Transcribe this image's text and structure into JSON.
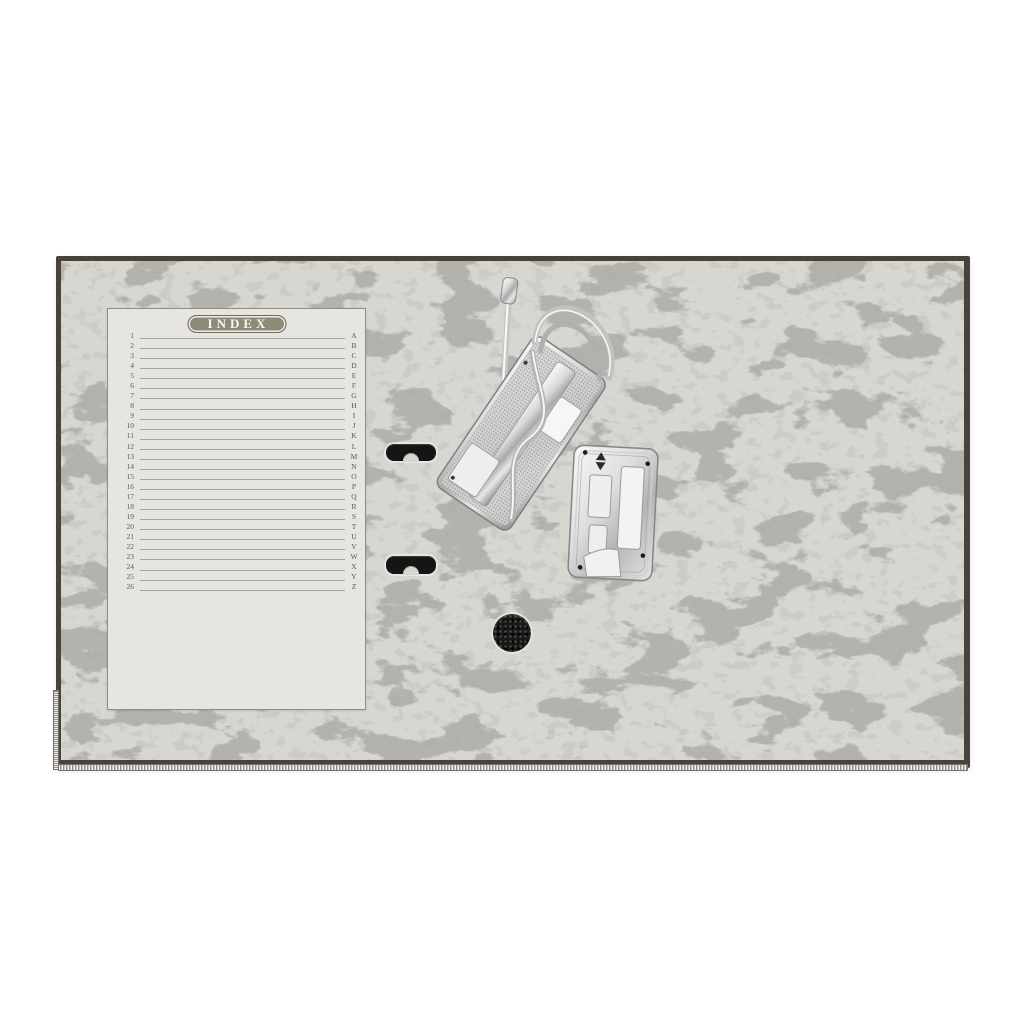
{
  "scene": {
    "subject": "lever arch file binder opened, inside view",
    "parts": [
      "marble-board",
      "index-card",
      "lever-arch-mechanism",
      "compressor-plate",
      "finger-slot-top",
      "finger-slot-bottom",
      "grip-hole",
      "metal-edge-strip-bottom",
      "metal-edge-strip-left"
    ]
  },
  "index_card": {
    "title": "INDEX",
    "rows": [
      {
        "num": "1",
        "letter": "A"
      },
      {
        "num": "2",
        "letter": "B"
      },
      {
        "num": "3",
        "letter": "C"
      },
      {
        "num": "4",
        "letter": "D"
      },
      {
        "num": "5",
        "letter": "E"
      },
      {
        "num": "6",
        "letter": "F"
      },
      {
        "num": "7",
        "letter": "G"
      },
      {
        "num": "8",
        "letter": "H"
      },
      {
        "num": "9",
        "letter": "I"
      },
      {
        "num": "10",
        "letter": "J"
      },
      {
        "num": "11",
        "letter": "K"
      },
      {
        "num": "12",
        "letter": "L"
      },
      {
        "num": "13",
        "letter": "M"
      },
      {
        "num": "14",
        "letter": "N"
      },
      {
        "num": "15",
        "letter": "O"
      },
      {
        "num": "16",
        "letter": "P"
      },
      {
        "num": "17",
        "letter": "Q"
      },
      {
        "num": "18",
        "letter": "R"
      },
      {
        "num": "19",
        "letter": "S"
      },
      {
        "num": "20",
        "letter": "T"
      },
      {
        "num": "21",
        "letter": "U"
      },
      {
        "num": "22",
        "letter": "V"
      },
      {
        "num": "23",
        "letter": "W"
      },
      {
        "num": "24",
        "letter": "X"
      },
      {
        "num": "25",
        "letter": "Y"
      },
      {
        "num": "26",
        "letter": "Z"
      }
    ]
  },
  "colors": {
    "page_bg": "#ffffff",
    "cover_edge": "#48423a",
    "texture_base": "#d8d6d1",
    "texture_fiber": "#6f6c65",
    "card_bg": "#e6e5e0",
    "card_border": "#8f8d86",
    "pill_bg": "#8f8a79",
    "pill_text": "#f7f6f2",
    "rule_line": "#9d9a93",
    "index_text": "#5a5852",
    "slot_dark": "#151515",
    "chrome_light": "#f2f2f2",
    "chrome_dark": "#9a9a9a"
  }
}
